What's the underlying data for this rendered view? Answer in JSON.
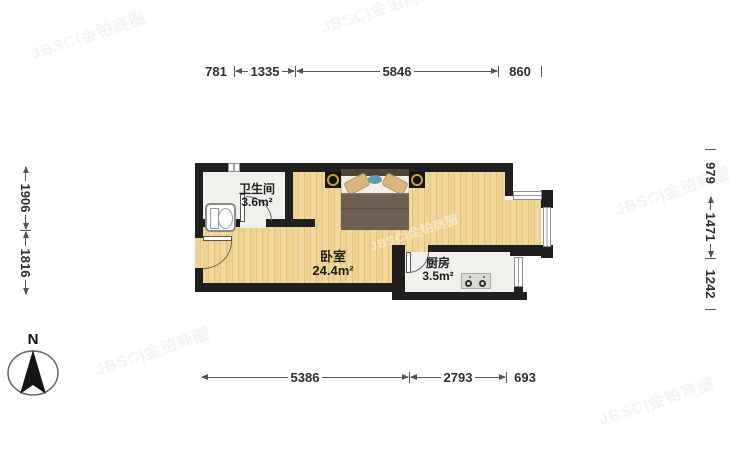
{
  "plan": {
    "compass_label": "N",
    "rooms": [
      {
        "name": "卫生间",
        "area": "3.6m²"
      },
      {
        "name": "卧室",
        "area": "24.4m²"
      },
      {
        "name": "厨房",
        "area": "3.5m²"
      }
    ]
  },
  "dimensions": {
    "top": [
      "781",
      "1335",
      "5846",
      "860"
    ],
    "bottom": [
      "5386",
      "2793",
      "693"
    ],
    "left": [
      "1906",
      "1816"
    ],
    "right": [
      "979",
      "1471",
      "1242"
    ]
  },
  "watermark": {
    "text": "JBSC|金铂商圈"
  },
  "colors": {
    "wall": "#1f1f1f",
    "wood_floor": "#eed290",
    "tile_floor": "#f2f0ec",
    "dim_text": "#2e2e2e",
    "blanket": "#6d6052",
    "lamp_gold": "#c9a227",
    "pillow_blue": "#5b9bb5"
  }
}
